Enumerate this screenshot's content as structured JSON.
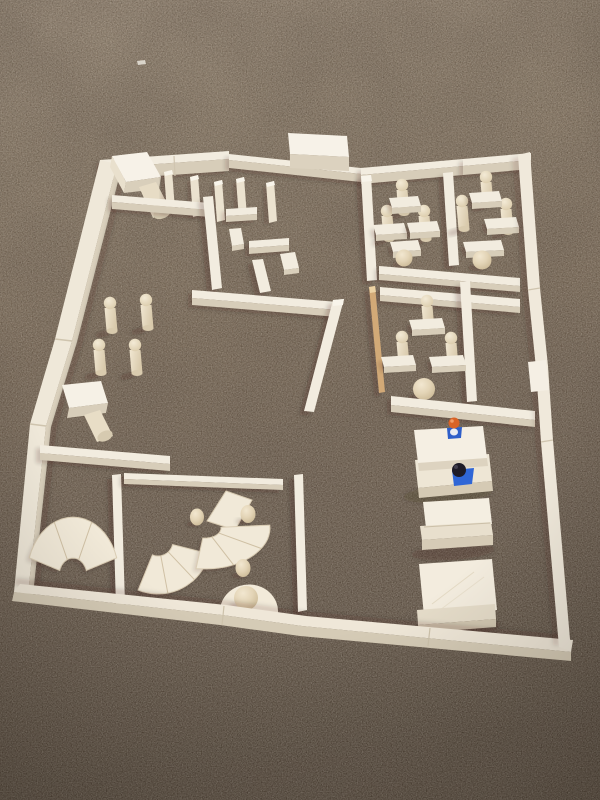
{
  "meta": {
    "description": "Photograph taken from above of a floor plan built from light wooden unit blocks arranged on dark brown carpet: outer walls forming a large tilted rectangle, interior rooms with peg people, desks, fan-shaped arc blocks, wooden balls, stacked platforms and two small toy figures (orange head, dark head).",
    "width": 600,
    "height": 800
  },
  "palette": {
    "wood_top": "#f2ecdf",
    "wood_side": "#d7cdb9",
    "wood_bright": "#f8f4ea",
    "wood_mid": "#ebe2cf",
    "peg_base": "#d9cbae",
    "fan_fill": "#f1e9d8",
    "fan_edge": "#d9ccb3",
    "fan_line": "#cfc0a4",
    "shadow": "rgba(35,25,15,0.20)",
    "carpet_stops": [
      [
        "0%",
        "#90806e"
      ],
      [
        "20%",
        "#837360"
      ],
      [
        "45%",
        "#746351"
      ],
      [
        "70%",
        "#635446"
      ],
      [
        "100%",
        "#4e4236"
      ]
    ],
    "peg_body": [
      [
        "0%",
        "#f1e7d2"
      ],
      [
        "100%",
        "#d8c9ab"
      ]
    ],
    "peg_head": [
      [
        "0%",
        "#f3ead6"
      ],
      [
        "100%",
        "#d8c8a6"
      ]
    ],
    "sphere": [
      [
        "0%",
        "#f2e7d0"
      ],
      [
        "45%",
        "#e3d4b6"
      ],
      [
        "100%",
        "#c3b08b"
      ]
    ],
    "figure_orange": "#d96327",
    "figure_blue": "#2e5ec9",
    "figure_dark": "#1e1b26",
    "figure_white": "#e9ebf1"
  },
  "scene": {
    "elements": [
      {
        "t": "poly",
        "name": "lint-speck",
        "p": "137,61 145,60 146,64 138,65",
        "f": "#e8e4da",
        "o": 0.85
      },
      {
        "t": "wallH",
        "name": "outer-wall-top-left",
        "x1": 100,
        "y1": 160,
        "x2": 229,
        "y2": 151,
        "w": 8,
        "h": 12,
        "sh": 1
      },
      {
        "t": "line",
        "name": "wall-seam",
        "x1": 174,
        "y1": 156,
        "x2": 175,
        "y2": 176,
        "s": "#d0c5b0",
        "sw": 1.2
      },
      {
        "t": "wallH",
        "name": "outer-wall-top-mid",
        "x1": 229,
        "y1": 154,
        "x2": 361,
        "y2": 168,
        "w": 6,
        "h": 8,
        "sh": 1
      },
      {
        "t": "wallH",
        "name": "outer-wall-top-right",
        "x1": 361,
        "y1": 168,
        "x2": 463,
        "y2": 159,
        "w": 7,
        "h": 9,
        "sh": 1
      },
      {
        "t": "wallH",
        "name": "outer-wall-top-corner",
        "x1": 463,
        "y1": 159,
        "x2": 531,
        "y2": 153,
        "w": 7,
        "h": 9,
        "sh": 1
      },
      {
        "t": "poly",
        "name": "gate-block-top",
        "p": "288,133 347,136 349,157 290,154",
        "f": "#f7f2e8"
      },
      {
        "t": "poly",
        "name": "gate-block-front",
        "p": "290,154 349,157 349,171 290,168",
        "f": "#dcd2bf"
      },
      {
        "t": "poly",
        "name": "outer-wall-left",
        "p": "100,160 117,164 72,341 46,426 28,594 14,592 30,424 55,339",
        "f": "#efe8d9"
      },
      {
        "t": "poly",
        "name": "outer-wall-left-shade",
        "p": "117,164 122,166 77,342 51,427 33,595 28,594 46,426 72,341",
        "f": "#dbd1bd"
      },
      {
        "t": "poly",
        "name": "left-wall-carpet-shadow",
        "p": "122,166 128,168 83,343 57,428 39,596 33,595 51,427 77,342",
        "f": "rgba(35,25,15,0.15)",
        "blur": 1
      },
      {
        "t": "line",
        "name": "wall-seam",
        "x1": 55,
        "y1": 339,
        "x2": 72,
        "y2": 341,
        "s": "#cfc4ae",
        "sw": 1.5
      },
      {
        "t": "line",
        "name": "wall-seam",
        "x1": 30,
        "y1": 424,
        "x2": 46,
        "y2": 426,
        "s": "#cfc4ae",
        "sw": 1.5
      },
      {
        "t": "poly",
        "name": "mallet-block-top",
        "p": "112,156 147,152 161,177 126,182",
        "f": "#f7f2e8"
      },
      {
        "t": "poly",
        "name": "mallet-block-front",
        "p": "126,182 161,177 159,189 124,193",
        "f": "#d9cfbb"
      },
      {
        "t": "poly",
        "name": "mallet-block-side",
        "p": "112,156 126,182 124,193 110,167",
        "f": "#e9e0cd"
      },
      {
        "t": "poly",
        "name": "mallet-cylinder",
        "p": "139,187 156,182 171,211 153,218",
        "f": "#e7dcc5"
      },
      {
        "t": "ellipse",
        "name": "mallet-cylinder-base",
        "cx": 162,
        "cy": 213,
        "rx": 9,
        "ry": 5.5,
        "rot": -22,
        "f": "#d8ccb2"
      },
      {
        "t": "post",
        "name": "fence-post",
        "x": 164,
        "y": 170
      },
      {
        "t": "post",
        "name": "fence-post",
        "x": 190,
        "y": 175
      },
      {
        "t": "post",
        "name": "fence-post",
        "x": 214,
        "y": 180
      },
      {
        "t": "post",
        "name": "fence-post",
        "x": 236,
        "y": 177
      },
      {
        "t": "post",
        "name": "fence-post",
        "x": 266,
        "y": 181
      },
      {
        "t": "wallH",
        "name": "maze-wall-top",
        "x1": 112,
        "y1": 195,
        "x2": 210,
        "y2": 203,
        "w": 7,
        "h": 7,
        "sh": 1
      },
      {
        "t": "band",
        "name": "maze-wall-vertical",
        "p": "203,197 213,196 222,288 212,290",
        "sh": 1
      },
      {
        "t": "wallH",
        "name": "maze-wall",
        "x1": 226,
        "y1": 209,
        "x2": 257,
        "y2": 207,
        "w": 7,
        "h": 6,
        "sh": 1
      },
      {
        "t": "poly",
        "name": "maze-block",
        "p": "229,229 241,228 244,244 232,246",
        "f": "#f2ecdf"
      },
      {
        "t": "poly",
        "name": "maze-block-side",
        "p": "232,246 244,244 244,249 232,251",
        "f": "#d9cfbb"
      },
      {
        "t": "wallH",
        "name": "maze-wall",
        "x1": 249,
        "y1": 241,
        "x2": 289,
        "y2": 238,
        "w": 7,
        "h": 6,
        "sh": 1
      },
      {
        "t": "poly",
        "name": "maze-block",
        "p": "280,254 295,252 299,268 284,270",
        "f": "#f2ecdf"
      },
      {
        "t": "poly",
        "name": "maze-block-side",
        "p": "284,270 299,268 299,273 284,275",
        "f": "#d9cfbb"
      },
      {
        "t": "band",
        "name": "maze-wall-vertical",
        "p": "252,260 263,259 271,291 260,293",
        "sh": 1
      },
      {
        "t": "wallH",
        "name": "maze-wall-bottom",
        "x1": 192,
        "y1": 290,
        "x2": 338,
        "y2": 302,
        "w": 8,
        "h": 7,
        "sh": 1
      },
      {
        "t": "band",
        "name": "center-tilted-wall",
        "p": "333,300 344,299 314,412 304,411",
        "sh": 1,
        "cap": "333,300 344,299 343,305 333,306"
      },
      {
        "t": "poly",
        "name": "table-block-top",
        "p": "62,385 101,381 108,403 69,408",
        "f": "#f6f1e6"
      },
      {
        "t": "poly",
        "name": "table-block-front",
        "p": "69,408 108,403 106,413 67,418",
        "f": "#d8ceba"
      },
      {
        "t": "poly",
        "name": "table-cylinder",
        "p": "84,415 100,410 113,436 97,442",
        "f": "#e8ddc6"
      },
      {
        "t": "ellipse",
        "name": "table-cylinder-base",
        "cx": 105,
        "cy": 436,
        "rx": 8,
        "ry": 5,
        "rot": -25,
        "f": "#d6cab0"
      },
      {
        "t": "wallH",
        "name": "left-room-wall",
        "x1": 40,
        "y1": 445,
        "x2": 170,
        "y2": 456,
        "w": 8,
        "h": 7,
        "sh": 1
      },
      {
        "t": "peg",
        "name": "peg-person",
        "x": 110,
        "y": 297
      },
      {
        "t": "peg",
        "name": "peg-person",
        "x": 146,
        "y": 294
      },
      {
        "t": "peg",
        "name": "peg-person",
        "x": 99,
        "y": 339
      },
      {
        "t": "peg",
        "name": "peg-person",
        "x": 135,
        "y": 339
      },
      {
        "t": "band",
        "name": "fan-room-wall-left",
        "p": "112,475 121,474 125,604 116,606",
        "sh": 1
      },
      {
        "t": "wallH",
        "name": "fan-room-wall-top",
        "x1": 124,
        "y1": 473,
        "x2": 283,
        "y2": 479,
        "w": 6,
        "h": 5,
        "sh": 1
      },
      {
        "t": "band",
        "name": "fan-room-wall-right",
        "p": "294,475 303,474 307,610 298,612",
        "sh": 1
      },
      {
        "t": "fan",
        "name": "fan-block-left",
        "cx": 73,
        "cy": 576,
        "r0": 14,
        "r1": 46,
        "a0": 198,
        "a1": 342,
        "sy": 1.28,
        "segs": 3
      },
      {
        "t": "fan",
        "name": "fan-block-lower",
        "cx": 158,
        "cy": 541,
        "r0": 15,
        "r1": 53,
        "a0": 14,
        "a1": 112,
        "sy": 1.0,
        "segs": 3
      },
      {
        "t": "poly",
        "name": "fan-wedge-block",
        "p": "207,521 226,491 252,500 235,530",
        "f": "#f1e9d8",
        "stroke": "#d9ccb3",
        "sw": 1
      },
      {
        "t": "fan",
        "name": "fan-block-upper",
        "cx": 205,
        "cy": 528,
        "r0": 16,
        "r1": 65,
        "a0": -4,
        "a1": 98,
        "sy": 0.63,
        "segs": 3
      },
      {
        "t": "egg",
        "name": "wood-egg",
        "cx": 197,
        "cy": 517,
        "rx": 7,
        "ry": 8.5
      },
      {
        "t": "egg",
        "name": "wood-egg",
        "cx": 248,
        "cy": 514,
        "rx": 7.5,
        "ry": 9
      },
      {
        "t": "egg",
        "name": "wood-egg",
        "cx": 243,
        "cy": 568,
        "rx": 7.5,
        "ry": 9
      },
      {
        "t": "path",
        "name": "half-disc-block",
        "dd": "M 220,610 A 29,27 0 0 1 278,613 Z",
        "f": "#f2ead9"
      },
      {
        "t": "sphere",
        "name": "wood-ball",
        "cx": 246,
        "cy": 598,
        "r": 12
      },
      {
        "t": "band",
        "name": "classroom-wall-left",
        "p": "361,176 371,175 377,280 367,281",
        "sh": 1,
        "cap": "361,176 371,175 372,181 362,182"
      },
      {
        "t": "band",
        "name": "classroom-divider",
        "p": "443,173 453,172 459,265 449,266",
        "sh": 1
      },
      {
        "t": "peg",
        "name": "peg-person",
        "x": 402,
        "y": 179
      },
      {
        "t": "peg",
        "name": "peg-person",
        "x": 387,
        "y": 205
      },
      {
        "t": "peg",
        "name": "peg-person",
        "x": 424,
        "y": 205
      },
      {
        "t": "peg",
        "name": "peg-person",
        "x": 486,
        "y": 171
      },
      {
        "t": "peg",
        "name": "peg-person",
        "x": 462,
        "y": 195
      },
      {
        "t": "peg",
        "name": "peg-person",
        "x": 506,
        "y": 198
      },
      {
        "t": "desk",
        "name": "desk-block",
        "x": 389,
        "y": 196,
        "w": 29
      },
      {
        "t": "desk",
        "name": "desk-block",
        "x": 373,
        "y": 223,
        "w": 31
      },
      {
        "t": "desk",
        "name": "desk-block",
        "x": 407,
        "y": 221,
        "w": 30
      },
      {
        "t": "desk",
        "name": "desk-block",
        "x": 390,
        "y": 240,
        "w": 28
      },
      {
        "t": "desk",
        "name": "desk-block",
        "x": 469,
        "y": 191,
        "w": 30
      },
      {
        "t": "desk",
        "name": "desk-block",
        "x": 484,
        "y": 217,
        "w": 32
      },
      {
        "t": "desk",
        "name": "desk-block",
        "x": 463,
        "y": 240,
        "w": 38
      },
      {
        "t": "sphere",
        "name": "ball-person",
        "cx": 404,
        "cy": 258,
        "r": 8.5
      },
      {
        "t": "sphere",
        "name": "ball-person",
        "cx": 482,
        "cy": 260,
        "r": 9.5
      },
      {
        "t": "wallH",
        "name": "classroom-wall-bottom",
        "x1": 379,
        "y1": 266,
        "x2": 520,
        "y2": 278,
        "w": 8,
        "h": 6,
        "sh": 1
      },
      {
        "t": "wallH",
        "name": "room2-wall-top",
        "x1": 380,
        "y1": 287,
        "x2": 520,
        "y2": 299,
        "w": 8,
        "h": 6,
        "sh": 1
      },
      {
        "t": "band",
        "name": "tan-stick",
        "p": "369,287 375,286 385,392 379,393",
        "f": "#d2a977",
        "cap": "369,287 375,286 376,292 370,293",
        "capf": "#ecd2a4",
        "sh": 1
      },
      {
        "t": "band",
        "name": "room2-divider",
        "p": "460,282 470,281 477,401 467,402",
        "sh": 1
      },
      {
        "t": "peg",
        "name": "peg-person",
        "x": 427,
        "y": 295
      },
      {
        "t": "peg",
        "name": "peg-person",
        "x": 402,
        "y": 331
      },
      {
        "t": "peg",
        "name": "peg-person",
        "x": 451,
        "y": 332
      },
      {
        "t": "desk",
        "name": "desk-block",
        "x": 409,
        "y": 318,
        "w": 33
      },
      {
        "t": "desk",
        "name": "desk-block",
        "x": 381,
        "y": 355,
        "w": 32
      },
      {
        "t": "desk",
        "name": "desk-block",
        "x": 429,
        "y": 355,
        "w": 34
      },
      {
        "t": "sphere",
        "name": "ball-person-large",
        "cx": 424,
        "cy": 389,
        "r": 11
      },
      {
        "t": "wallH",
        "name": "room2-wall-bottom",
        "x1": 391,
        "y1": 396,
        "x2": 535,
        "y2": 411,
        "w": 9,
        "h": 7,
        "sh": 1
      },
      {
        "t": "ellipse",
        "name": "platform-shadow",
        "cx": 448,
        "cy": 494,
        "rx": 45,
        "ry": 9,
        "rot": -4,
        "f": "rgba(35,25,15,0.18)",
        "blur": 1
      },
      {
        "t": "poly",
        "name": "platform1-lower-top",
        "p": "415,460 489,454 492,481 418,488",
        "f": "#eee6d5"
      },
      {
        "t": "poly",
        "name": "platform1-lower-front",
        "p": "418,488 492,481 493,491 419,498",
        "f": "#d5cab4"
      },
      {
        "t": "poly",
        "name": "platform1-upper-top",
        "p": "414,430 483,426 487,458 418,463",
        "f": "#f5efe3"
      },
      {
        "t": "poly",
        "name": "platform1-upper-front",
        "p": "418,463 487,458 488,466 419,471",
        "f": "#ddd3c0"
      },
      {
        "t": "poly",
        "name": "platform1-left-edge",
        "p": "414,430 418,463 419,471 415,438",
        "f": "#e7decb"
      },
      {
        "t": "poly",
        "name": "figure-orange-body",
        "p": "447,428 462,427 461,438 448,439",
        "f": "#2e5ec9"
      },
      {
        "t": "ellipse",
        "name": "figure-orange-chest",
        "cx": 454,
        "cy": 432,
        "rx": 4,
        "ry": 3.5,
        "f": "#e9ebf1"
      },
      {
        "t": "circle",
        "name": "figure-orange-head",
        "cx": 454,
        "cy": 423,
        "r": 5.5,
        "f": "#d96327"
      },
      {
        "t": "circle",
        "name": "figure-orange-head-shine",
        "cx": 452,
        "cy": 421,
        "r": 1.8,
        "f": "#f2a271",
        "o": 0.9
      },
      {
        "t": "poly",
        "name": "figure-dark-body",
        "p": "452,470 474,468 472,484 454,486",
        "f": "#2f66d6"
      },
      {
        "t": "circle",
        "name": "figure-dark-head",
        "cx": 459,
        "cy": 470,
        "r": 7,
        "f": "#1e1b26"
      },
      {
        "t": "circle",
        "name": "figure-dark-head-shine",
        "cx": 456,
        "cy": 467,
        "r": 2,
        "f": "#4a4656",
        "o": 0.8
      },
      {
        "t": "ellipse",
        "name": "platform-shadow",
        "cx": 453,
        "cy": 552,
        "rx": 42,
        "ry": 8,
        "rot": -4,
        "f": "rgba(35,25,15,0.16)",
        "blur": 1
      },
      {
        "t": "poly",
        "name": "platform2-top",
        "p": "423,502 489,498 492,524 426,528",
        "f": "#f4eee1"
      },
      {
        "t": "poly",
        "name": "platform2-lip",
        "p": "420,526 491,522 493,535 422,540",
        "f": "#e8dfcd"
      },
      {
        "t": "poly",
        "name": "platform2-front",
        "p": "422,540 493,535 493,545 422,550",
        "f": "#d6cbb6"
      },
      {
        "t": "line",
        "name": "platform2-seam",
        "x1": 424,
        "y1": 527,
        "x2": 490,
        "y2": 523,
        "s": "#cbbfa8",
        "sw": 1
      },
      {
        "t": "ellipse",
        "name": "platform-shadow",
        "cx": 456,
        "cy": 628,
        "rx": 45,
        "ry": 9,
        "rot": -4,
        "f": "rgba(35,25,15,0.16)",
        "blur": 1
      },
      {
        "t": "poly",
        "name": "platform3-top",
        "p": "419,564 492,559 497,610 424,616",
        "f": "#f3ecde"
      },
      {
        "t": "line",
        "name": "platform3-grain",
        "x1": 432,
        "y1": 604,
        "x2": 474,
        "y2": 572,
        "s": "#e4dac4",
        "sw": 1
      },
      {
        "t": "line",
        "name": "platform3-grain",
        "x1": 440,
        "y1": 610,
        "x2": 484,
        "y2": 577,
        "s": "#e4dac4",
        "sw": 1,
        "o": 0.7
      },
      {
        "t": "poly",
        "name": "platform3-lip",
        "p": "417,610 495,604 496,619 418,625",
        "f": "#e5dcc9"
      },
      {
        "t": "poly",
        "name": "platform3-front",
        "p": "418,625 496,619 496,627 419,633",
        "f": "#d2c7b1"
      },
      {
        "t": "poly",
        "name": "bottom-wall-carpet-shadow",
        "p": "16,578 224,600 304,611 571,635 570,641 302,617 221,606 13,585",
        "f": "rgba(35,25,15,0.15)",
        "blur": 1
      },
      {
        "t": "poly",
        "name": "outer-wall-bottom-top",
        "p": "20,584 226,605 306,616 573,640 571,652 302,626 222,615 14,592",
        "f": "#efe7d8"
      },
      {
        "t": "poly",
        "name": "outer-wall-bottom-front",
        "p": "14,592 222,615 302,626 571,652 571,661 300,636 220,625 12,601",
        "f": "#d5cbb6"
      },
      {
        "t": "line",
        "name": "wall-seam",
        "x1": 224,
        "y1": 606,
        "x2": 222,
        "y2": 625,
        "s": "#cdc2ab",
        "sw": 1.2
      },
      {
        "t": "line",
        "name": "wall-seam",
        "x1": 430,
        "y1": 628,
        "x2": 428,
        "y2": 646,
        "s": "#cdc2ab",
        "sw": 1.2
      },
      {
        "t": "poly",
        "name": "right-wall-carpet-shadow",
        "p": "512,158 522,290 530,368 535,442 553,645 559,646 547,441 542,367 534,289 524,156",
        "f": "rgba(35,25,15,0.13)",
        "blur": 1
      },
      {
        "t": "poly",
        "name": "outer-wall-right",
        "p": "518,155 528,290 536,368 541,442 559,647 571,651 553,440 548,366 540,288 530,152",
        "f": "#f0e9db"
      },
      {
        "t": "poly",
        "name": "right-wall-bright-cap",
        "p": "528,362 546,360 549,390 531,392",
        "f": "#f5efe4"
      },
      {
        "t": "line",
        "name": "wall-seam",
        "x1": 528,
        "y1": 290,
        "x2": 540,
        "y2": 288,
        "s": "#cfc4ae",
        "sw": 1.2
      },
      {
        "t": "line",
        "name": "wall-seam",
        "x1": 541,
        "y1": 442,
        "x2": 553,
        "y2": 440,
        "s": "#cfc4ae",
        "sw": 1.2
      }
    ]
  }
}
